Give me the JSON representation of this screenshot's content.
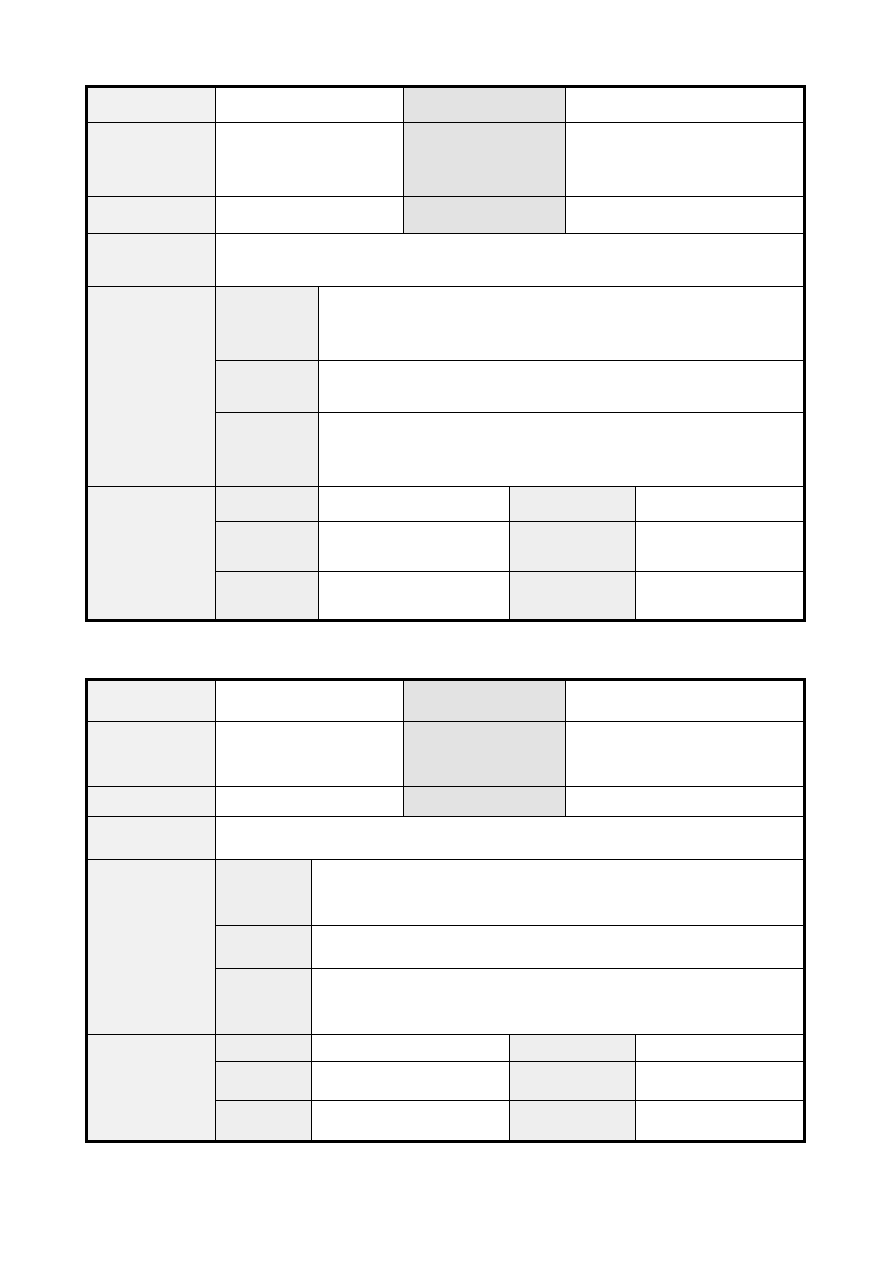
{
  "page": {
    "width": 893,
    "height": 1262,
    "background": "#ffffff"
  },
  "colors": {
    "border": "#000000",
    "header_light": "#f1f1f1",
    "header_dark": "#e3e3e3",
    "subheader": "#eeeeee",
    "cell_white": "#ffffff"
  },
  "tables": [
    {
      "name": "form-table-1",
      "left": 85,
      "top": 85,
      "width": 721,
      "height": 537,
      "cells": [
        {
          "n": "row1-label",
          "x": 0,
          "y": 0,
          "w": 128,
          "h": 35,
          "f": "header_light"
        },
        {
          "n": "row1-value",
          "x": 128,
          "y": 0,
          "w": 188,
          "h": 35,
          "f": "cell_white"
        },
        {
          "n": "row1-label2",
          "x": 316,
          "y": 0,
          "w": 162,
          "h": 35,
          "f": "header_dark"
        },
        {
          "n": "row1-value2",
          "x": 478,
          "y": 0,
          "w": 237,
          "h": 35,
          "f": "cell_white"
        },
        {
          "n": "row2-label",
          "x": 0,
          "y": 35,
          "w": 128,
          "h": 74,
          "f": "header_light"
        },
        {
          "n": "row2-value",
          "x": 128,
          "y": 35,
          "w": 188,
          "h": 74,
          "f": "cell_white"
        },
        {
          "n": "row2-label2",
          "x": 316,
          "y": 35,
          "w": 162,
          "h": 74,
          "f": "header_dark"
        },
        {
          "n": "row2-value2",
          "x": 478,
          "y": 35,
          "w": 237,
          "h": 74,
          "f": "cell_white"
        },
        {
          "n": "row3-label",
          "x": 0,
          "y": 109,
          "w": 128,
          "h": 37,
          "f": "header_light"
        },
        {
          "n": "row3-value",
          "x": 128,
          "y": 109,
          "w": 188,
          "h": 37,
          "f": "cell_white"
        },
        {
          "n": "row3-label2",
          "x": 316,
          "y": 109,
          "w": 162,
          "h": 37,
          "f": "header_dark"
        },
        {
          "n": "row3-value2",
          "x": 478,
          "y": 109,
          "w": 237,
          "h": 37,
          "f": "cell_white"
        },
        {
          "n": "row4-label",
          "x": 0,
          "y": 146,
          "w": 128,
          "h": 53,
          "f": "header_light"
        },
        {
          "n": "row4-value",
          "x": 128,
          "y": 146,
          "w": 587,
          "h": 53,
          "f": "cell_white"
        },
        {
          "n": "section1-label",
          "x": 0,
          "y": 199,
          "w": 128,
          "h": 200,
          "f": "header_light"
        },
        {
          "n": "section1-row1-sublabel",
          "x": 128,
          "y": 199,
          "w": 103,
          "h": 74,
          "f": "subheader"
        },
        {
          "n": "section1-row1-value",
          "x": 231,
          "y": 199,
          "w": 484,
          "h": 74,
          "f": "cell_white"
        },
        {
          "n": "section1-row2-sublabel",
          "x": 128,
          "y": 273,
          "w": 103,
          "h": 52,
          "f": "subheader"
        },
        {
          "n": "section1-row2-value",
          "x": 231,
          "y": 273,
          "w": 484,
          "h": 52,
          "f": "cell_white"
        },
        {
          "n": "section1-row3-sublabel",
          "x": 128,
          "y": 325,
          "w": 103,
          "h": 74,
          "f": "subheader"
        },
        {
          "n": "section1-row3-value",
          "x": 231,
          "y": 325,
          "w": 484,
          "h": 74,
          "f": "cell_white"
        },
        {
          "n": "section2-label",
          "x": 0,
          "y": 399,
          "w": 128,
          "h": 132,
          "f": "header_light"
        },
        {
          "n": "section2-row1-sublabel",
          "x": 128,
          "y": 399,
          "w": 103,
          "h": 35,
          "f": "subheader"
        },
        {
          "n": "section2-row1-value",
          "x": 231,
          "y": 399,
          "w": 191,
          "h": 35,
          "f": "cell_white"
        },
        {
          "n": "section2-row1-sublabel2",
          "x": 422,
          "y": 399,
          "w": 126,
          "h": 35,
          "f": "subheader"
        },
        {
          "n": "section2-row1-value2",
          "x": 548,
          "y": 399,
          "w": 167,
          "h": 35,
          "f": "cell_white"
        },
        {
          "n": "section2-row2-sublabel",
          "x": 128,
          "y": 434,
          "w": 103,
          "h": 50,
          "f": "subheader"
        },
        {
          "n": "section2-row2-value",
          "x": 231,
          "y": 434,
          "w": 191,
          "h": 50,
          "f": "cell_white"
        },
        {
          "n": "section2-row2-sublabel2",
          "x": 422,
          "y": 434,
          "w": 126,
          "h": 50,
          "f": "subheader"
        },
        {
          "n": "section2-row2-value2",
          "x": 548,
          "y": 434,
          "w": 167,
          "h": 50,
          "f": "cell_white"
        },
        {
          "n": "section2-row3-sublabel",
          "x": 128,
          "y": 484,
          "w": 103,
          "h": 47,
          "f": "subheader"
        },
        {
          "n": "section2-row3-value",
          "x": 231,
          "y": 484,
          "w": 191,
          "h": 47,
          "f": "cell_white"
        },
        {
          "n": "section2-row3-sublabel2",
          "x": 422,
          "y": 484,
          "w": 126,
          "h": 47,
          "f": "subheader"
        },
        {
          "n": "section2-row3-value2",
          "x": 548,
          "y": 484,
          "w": 167,
          "h": 47,
          "f": "cell_white"
        }
      ]
    },
    {
      "name": "form-table-2",
      "left": 85,
      "top": 678,
      "width": 721,
      "height": 465,
      "cells": [
        {
          "n": "row1-label",
          "x": 0,
          "y": 0,
          "w": 128,
          "h": 41,
          "f": "header_light"
        },
        {
          "n": "row1-value",
          "x": 128,
          "y": 0,
          "w": 188,
          "h": 41,
          "f": "cell_white"
        },
        {
          "n": "row1-label2",
          "x": 316,
          "y": 0,
          "w": 162,
          "h": 41,
          "f": "header_dark"
        },
        {
          "n": "row1-value2",
          "x": 478,
          "y": 0,
          "w": 237,
          "h": 41,
          "f": "cell_white"
        },
        {
          "n": "row2-label",
          "x": 0,
          "y": 41,
          "w": 128,
          "h": 65,
          "f": "header_light"
        },
        {
          "n": "row2-value",
          "x": 128,
          "y": 41,
          "w": 188,
          "h": 65,
          "f": "cell_white"
        },
        {
          "n": "row2-label2",
          "x": 316,
          "y": 41,
          "w": 162,
          "h": 65,
          "f": "header_dark"
        },
        {
          "n": "row2-value2",
          "x": 478,
          "y": 41,
          "w": 237,
          "h": 65,
          "f": "cell_white"
        },
        {
          "n": "row3-label",
          "x": 0,
          "y": 106,
          "w": 128,
          "h": 30,
          "f": "header_light"
        },
        {
          "n": "row3-value",
          "x": 128,
          "y": 106,
          "w": 188,
          "h": 30,
          "f": "cell_white"
        },
        {
          "n": "row3-label2",
          "x": 316,
          "y": 106,
          "w": 162,
          "h": 30,
          "f": "header_dark"
        },
        {
          "n": "row3-value2",
          "x": 478,
          "y": 106,
          "w": 237,
          "h": 30,
          "f": "cell_white"
        },
        {
          "n": "row4-label",
          "x": 0,
          "y": 136,
          "w": 128,
          "h": 43,
          "f": "header_light"
        },
        {
          "n": "row4-value",
          "x": 128,
          "y": 136,
          "w": 587,
          "h": 43,
          "f": "cell_white"
        },
        {
          "n": "section1-label",
          "x": 0,
          "y": 179,
          "w": 128,
          "h": 175,
          "f": "header_light"
        },
        {
          "n": "section1-row1-sublabel",
          "x": 128,
          "y": 179,
          "w": 96,
          "h": 66,
          "f": "subheader"
        },
        {
          "n": "section1-row1-value",
          "x": 224,
          "y": 179,
          "w": 491,
          "h": 66,
          "f": "cell_white"
        },
        {
          "n": "section1-row2-sublabel",
          "x": 128,
          "y": 245,
          "w": 96,
          "h": 43,
          "f": "subheader"
        },
        {
          "n": "section1-row2-value",
          "x": 224,
          "y": 245,
          "w": 491,
          "h": 43,
          "f": "cell_white"
        },
        {
          "n": "section1-row3-sublabel",
          "x": 128,
          "y": 288,
          "w": 96,
          "h": 66,
          "f": "subheader"
        },
        {
          "n": "section1-row3-value",
          "x": 224,
          "y": 288,
          "w": 491,
          "h": 66,
          "f": "cell_white"
        },
        {
          "n": "section2-label",
          "x": 0,
          "y": 354,
          "w": 128,
          "h": 105,
          "f": "header_light"
        },
        {
          "n": "section2-row1-sublabel",
          "x": 128,
          "y": 354,
          "w": 96,
          "h": 27,
          "f": "subheader"
        },
        {
          "n": "section2-row1-value",
          "x": 224,
          "y": 354,
          "w": 198,
          "h": 27,
          "f": "cell_white"
        },
        {
          "n": "section2-row1-sublabel2",
          "x": 422,
          "y": 354,
          "w": 126,
          "h": 27,
          "f": "subheader"
        },
        {
          "n": "section2-row1-value2",
          "x": 548,
          "y": 354,
          "w": 167,
          "h": 27,
          "f": "cell_white"
        },
        {
          "n": "section2-row2-sublabel",
          "x": 128,
          "y": 381,
          "w": 96,
          "h": 39,
          "f": "subheader"
        },
        {
          "n": "section2-row2-value",
          "x": 224,
          "y": 381,
          "w": 198,
          "h": 39,
          "f": "cell_white"
        },
        {
          "n": "section2-row2-sublabel2",
          "x": 422,
          "y": 381,
          "w": 126,
          "h": 39,
          "f": "subheader"
        },
        {
          "n": "section2-row2-value2",
          "x": 548,
          "y": 381,
          "w": 167,
          "h": 39,
          "f": "cell_white"
        },
        {
          "n": "section2-row3-sublabel",
          "x": 128,
          "y": 420,
          "w": 96,
          "h": 39,
          "f": "subheader"
        },
        {
          "n": "section2-row3-value",
          "x": 224,
          "y": 420,
          "w": 198,
          "h": 39,
          "f": "cell_white"
        },
        {
          "n": "section2-row3-sublabel2",
          "x": 422,
          "y": 420,
          "w": 126,
          "h": 39,
          "f": "subheader"
        },
        {
          "n": "section2-row3-value2",
          "x": 548,
          "y": 420,
          "w": 167,
          "h": 39,
          "f": "cell_white"
        }
      ]
    }
  ]
}
